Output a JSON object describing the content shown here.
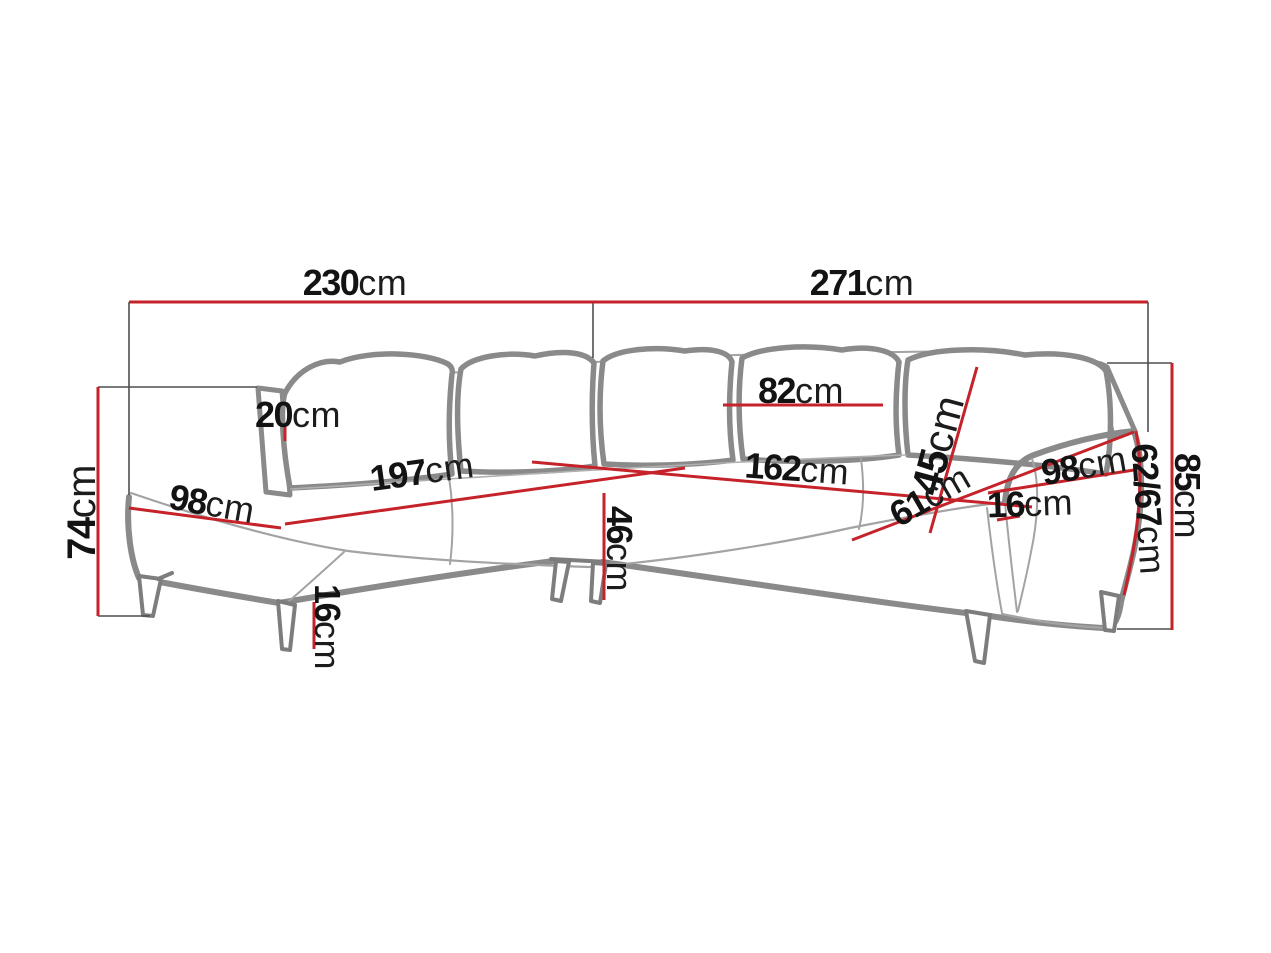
{
  "diagram": {
    "type": "furniture-dimension-diagram",
    "subject": "corner sofa with chaise",
    "measurement_unit": "cm",
    "colors": {
      "dimension_line_red": "#c5222a",
      "sofa_outline_gray": "#8a8a8a",
      "extension_line_gray": "#4f4f4f",
      "label_text": "#131313",
      "background": "#ffffff"
    },
    "dimensions": [
      {
        "name": "overall-width-left",
        "value": "230",
        "unit": "cm"
      },
      {
        "name": "overall-width-right",
        "value": "271",
        "unit": "cm"
      },
      {
        "name": "backrest-height-left",
        "value": "74",
        "unit": "cm"
      },
      {
        "name": "backrest-top-offset",
        "value": "20",
        "unit": "cm"
      },
      {
        "name": "chaise-depth",
        "value": "98",
        "unit": "cm"
      },
      {
        "name": "seat-width-left",
        "value": "197",
        "unit": "cm"
      },
      {
        "name": "seat-height",
        "value": "46",
        "unit": "cm"
      },
      {
        "name": "leg-height",
        "value": "16",
        "unit": "cm"
      },
      {
        "name": "back-cushion-width",
        "value": "82",
        "unit": "cm"
      },
      {
        "name": "back-cushion-height",
        "value": "45",
        "unit": "cm"
      },
      {
        "name": "seat-width-right",
        "value": "162",
        "unit": "cm"
      },
      {
        "name": "seat-depth-right",
        "value": "61",
        "unit": "cm"
      },
      {
        "name": "armrest-length",
        "value": "98",
        "unit": "cm"
      },
      {
        "name": "armrest-top-width",
        "value": "16",
        "unit": "cm"
      },
      {
        "name": "armrest-height",
        "value": "62/67",
        "unit": "cm"
      },
      {
        "name": "overall-height-right",
        "value": "85",
        "unit": "cm"
      }
    ]
  }
}
